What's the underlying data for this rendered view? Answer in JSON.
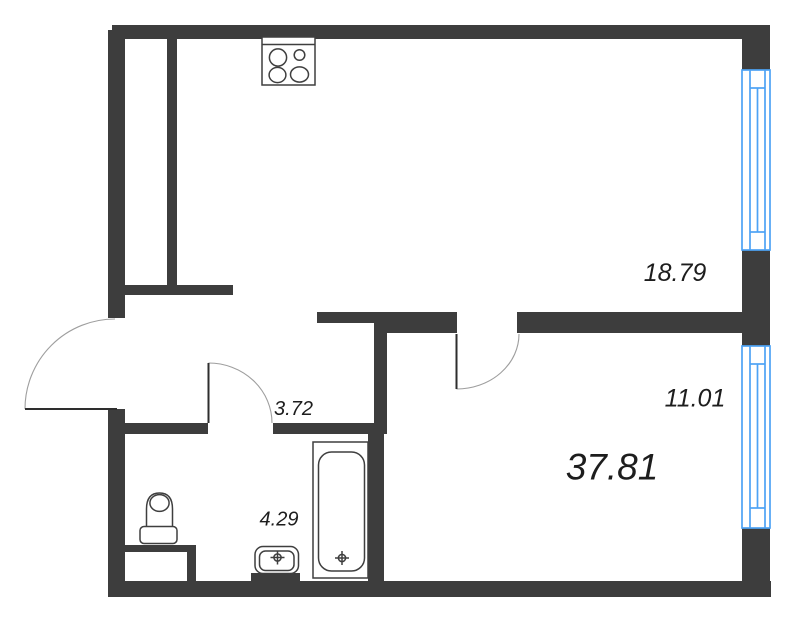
{
  "plan": {
    "areas": {
      "kitchen_living_room": "18.79",
      "bedroom": "11.01",
      "hallway": "3.72",
      "bathroom": "4.29",
      "total": "37.81"
    },
    "fixtures": {
      "stove": "stove-icon",
      "toilet": "toilet-icon",
      "sink": "sink-icon",
      "bathtub": "bathtub-icon",
      "drain": "drain-crosshair-icon",
      "window": "window-icon",
      "door": "door-swing-icon"
    },
    "colors": {
      "wall": "#3d3d3d",
      "window_frame": "#4da3f5",
      "fixture_line": "#3f3f3f",
      "door_arc": "#9e9e9e",
      "door_leaf": "#2e2e2e",
      "label": "#1d1d1d",
      "background": "#ffffff"
    }
  }
}
